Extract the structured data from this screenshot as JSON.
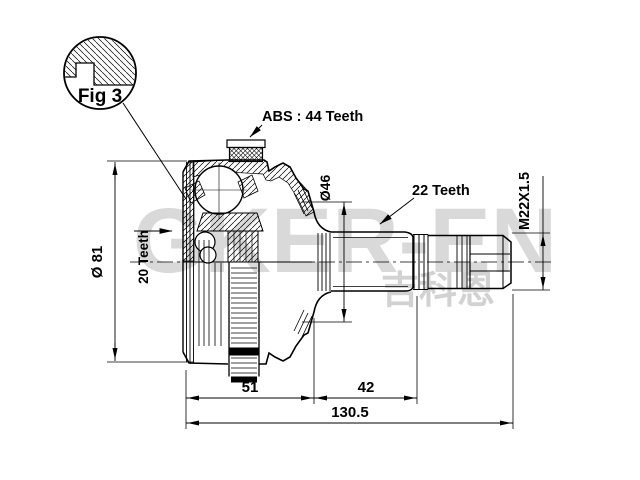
{
  "figure": {
    "label": "Fig 3"
  },
  "labels": {
    "abs": "ABS : 44 Teeth",
    "teeth20": "20 Teeth",
    "teeth22": "22 Teeth",
    "thread": "M22X1.5"
  },
  "dims": {
    "outer_dia": "Ø 81",
    "boot_dia": "Ø46",
    "bell_len": "51",
    "spline_len": "42",
    "total_len": "130.5"
  },
  "watermark": {
    "brand": "GKER-EN",
    "cjk": "吉科恩"
  },
  "colors": {
    "line": "#000000",
    "background": "#ffffff",
    "watermark": "#d9d9d9"
  }
}
